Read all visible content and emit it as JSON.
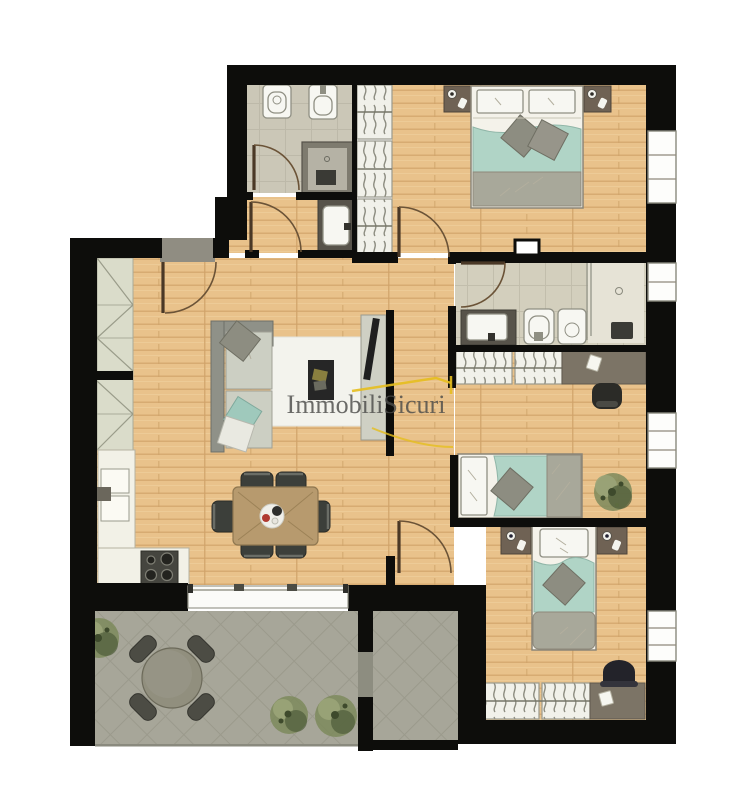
{
  "watermark": {
    "text": "ImmobiliSicuri"
  },
  "palette": {
    "wall": "#0d0d0b",
    "wood_base": "#e9c28b",
    "wood_grain": "#d7ab72",
    "wood_light": "#f3d6a5",
    "tile_bath_base": "#d3cfbd",
    "tile_bath_line": "#c2beac",
    "tile_terrace_base": "#a7a699",
    "tile_terrace_line": "#9b9a8c",
    "teal": "#b0d4c6",
    "blanket_gray": "#a8a89a",
    "white_fixture": "#f7f7f2",
    "counter_dark": "#57534a",
    "nightstand": "#6f6254",
    "desk": "#7c7466",
    "wardrobe_bg": "#f1f1ea",
    "chair_dark": "#3c3f3a",
    "dining_table": "#b79a6e",
    "stove": "#45453f",
    "rug": "#f3f3ed",
    "sofa_frame": "#8f9188",
    "sofa_cushion": "#cccfc3",
    "cabinet_bg": "#dadcca",
    "landing": "#908d82",
    "round_table": "#918f7e",
    "plant_dark": "#4f5c3a",
    "plant_mid": "#7d8a5c",
    "plant_light": "#9aa478",
    "door_arc": "#6b5337",
    "shower_dark": "#7e7b6f",
    "watermark_text_color": "#4c4c4a",
    "watermark_accent": "#e5be1e"
  }
}
